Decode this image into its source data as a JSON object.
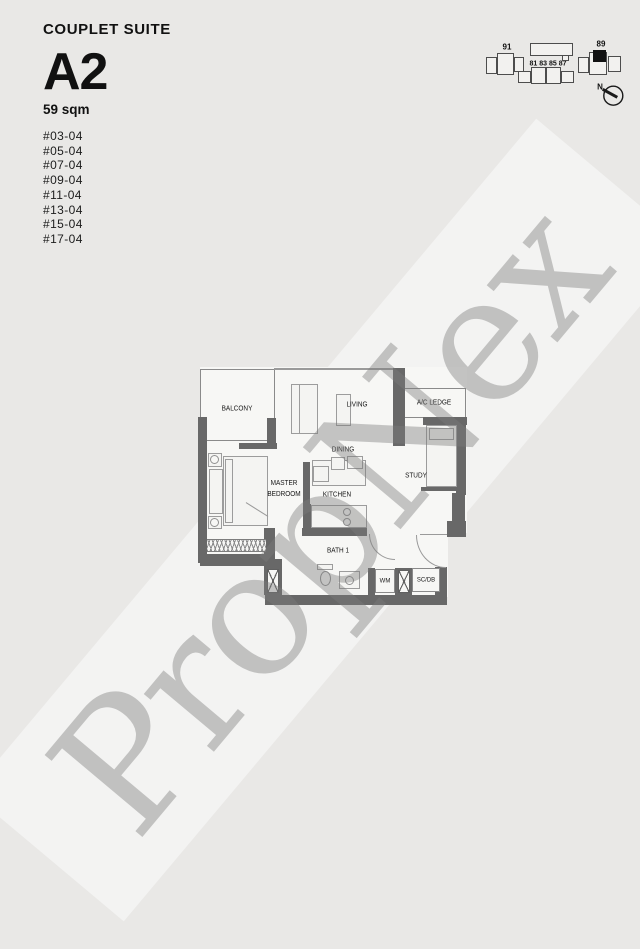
{
  "header": {
    "title": "COUPLET SUITE",
    "unit_type": "A2",
    "area": "59 sqm",
    "units": [
      "#03-04",
      "#05-04",
      "#07-04",
      "#09-04",
      "#11-04",
      "#13-04",
      "#15-04",
      "#17-04"
    ]
  },
  "keyplan": {
    "label_left": "91",
    "label_center": "81 83 85 87",
    "label_right": "89",
    "north_label": "N",
    "highlight_color": "#121212"
  },
  "floorplan": {
    "labels": {
      "balcony": "BALCONY",
      "living": "LIVING",
      "ac_ledge": "A/C LEDGE",
      "dining": "DINING",
      "master_line1": "MASTER",
      "master_line2": "BEDROOM",
      "kitchen": "KITCHEN",
      "study": "STUDY",
      "bath": "BATH 1",
      "wm": "WM",
      "scdb": "SC/DB"
    },
    "wall_color": "#686868",
    "floor_color": "#f7f7f5"
  },
  "watermark": {
    "text": "PropNex",
    "color": "#bababa"
  },
  "page": {
    "background": "#e9e8e6"
  }
}
